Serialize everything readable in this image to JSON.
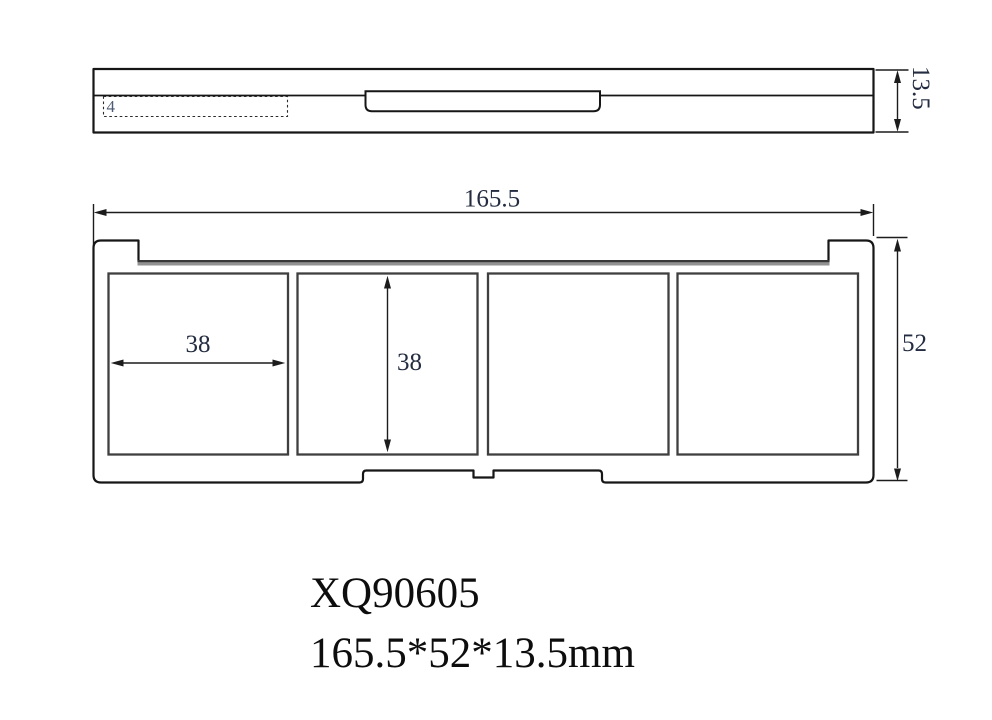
{
  "side_view": {
    "layer_callout": "4",
    "height_dim": "13.5"
  },
  "plan_view": {
    "overall_width_dim": "165.5",
    "overall_depth_dim": "52",
    "pan_width_dim": "38",
    "pan_depth_dim": "38",
    "pan_count": 4
  },
  "label_block": {
    "model_number": "XQ90605",
    "overall_size": "165.5*52*13.5mm"
  },
  "colors": {
    "dim_text": "#232c40",
    "callout_text": "#4d5b75",
    "title_text": "#0d0d0d",
    "hinge_band_fill": "#929292",
    "hinge_band_edge": "#383838"
  }
}
